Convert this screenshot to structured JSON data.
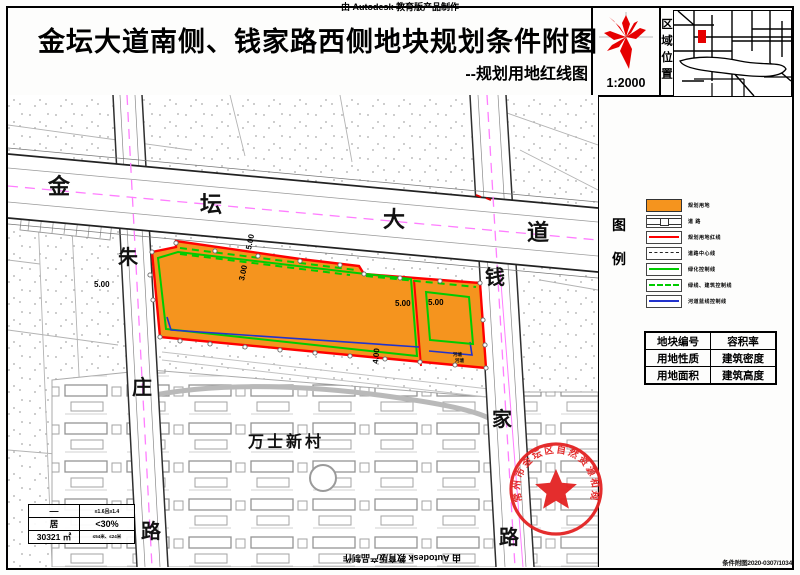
{
  "credits": {
    "top": "由 Autodesk 教育版产品制作",
    "bottom": "由 Autodesk 教育版产品制作"
  },
  "header": {
    "title": "金坛大道南侧、钱家路西侧地块规划条件附图",
    "subtitle": "--规划用地红线图",
    "scale": "1:2000",
    "region_label": "区域位置"
  },
  "legend": {
    "char_top": "图",
    "char_bottom": "例",
    "items": [
      {
        "label": "规划用地",
        "swatch": "orange-fill"
      },
      {
        "label": "道  路",
        "swatch": "road"
      },
      {
        "label": "规划用地红线",
        "swatch": "red-line"
      },
      {
        "label": "道路中心线",
        "swatch": "black-dash-line"
      },
      {
        "label": "绿化控制线",
        "swatch": "green-line"
      },
      {
        "label": "绿线、建筑控制线",
        "swatch": "green-dash-line"
      },
      {
        "label": "河道蓝线控制线",
        "swatch": "blue-line"
      }
    ]
  },
  "attribute_table": {
    "rows": [
      [
        "地块编号",
        "容积率"
      ],
      [
        "用地性质",
        "建筑密度"
      ],
      [
        "用地面积",
        "建筑高度"
      ]
    ]
  },
  "value_table": {
    "rows": [
      [
        "—",
        "≤1.6且≥1.4"
      ],
      [
        "居",
        "<30%"
      ],
      [
        "30321 ㎡",
        "≤54米、≤24米"
      ]
    ]
  },
  "map": {
    "roads": {
      "jintan_avenue": [
        "金",
        "坛",
        "大",
        "道"
      ],
      "zhuzhuang_road": [
        "朱",
        "庄",
        "路"
      ],
      "qianjia_road": [
        "钱",
        "家",
        "路"
      ]
    },
    "village": "万士新村",
    "pond": "河塘",
    "dimensions": {
      "left": "5.00",
      "top_a": "5.00",
      "top_b": "3.00",
      "mid_a": "5.00",
      "mid_b": "5.00",
      "bottom": "4.00"
    },
    "stamp": "常州市金坛区自然资源和规划局",
    "doc_no": "条件附图2020-0307/1034"
  },
  "colors": {
    "parcel_fill": "#F5941E",
    "red_line": "#FF0000",
    "green_line": "#00CC00",
    "blue_line": "#2233CC",
    "magenta_centerline": "#FF7DFF",
    "stamp_red": "#E32222"
  }
}
